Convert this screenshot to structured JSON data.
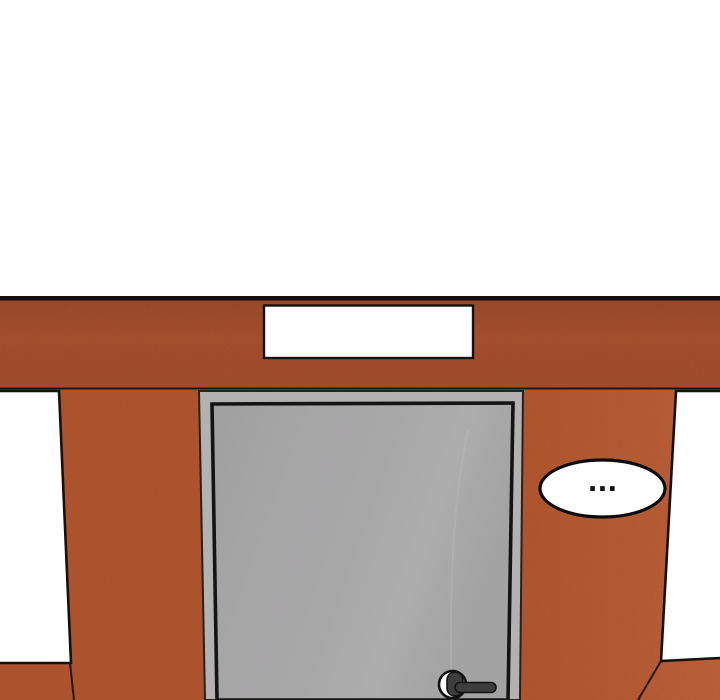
{
  "panel": {
    "speech_bubble": {
      "text": "..."
    },
    "sign": {
      "text": ""
    }
  },
  "icons": {
    "ellipsis": "ellipsis-speech-dots",
    "door_handle": "lever-door-handle"
  },
  "colors": {
    "background": "#ffffff",
    "fascia": "#aa5130",
    "wall": "#b4572f",
    "wall_highlight": "#cd6e41",
    "outline": "#1d1814",
    "sign_fill": "#ffffff",
    "window_fill": "#ffffff",
    "door_frame": "#b3b2b0",
    "door_panel": "#a6a5a6",
    "door_outline": "#141414",
    "handle_lever": "#3d3d3d",
    "handle_plate": "#fdfdfd",
    "bubble_fill": "#fefefe",
    "bubble_text": "#111111"
  }
}
